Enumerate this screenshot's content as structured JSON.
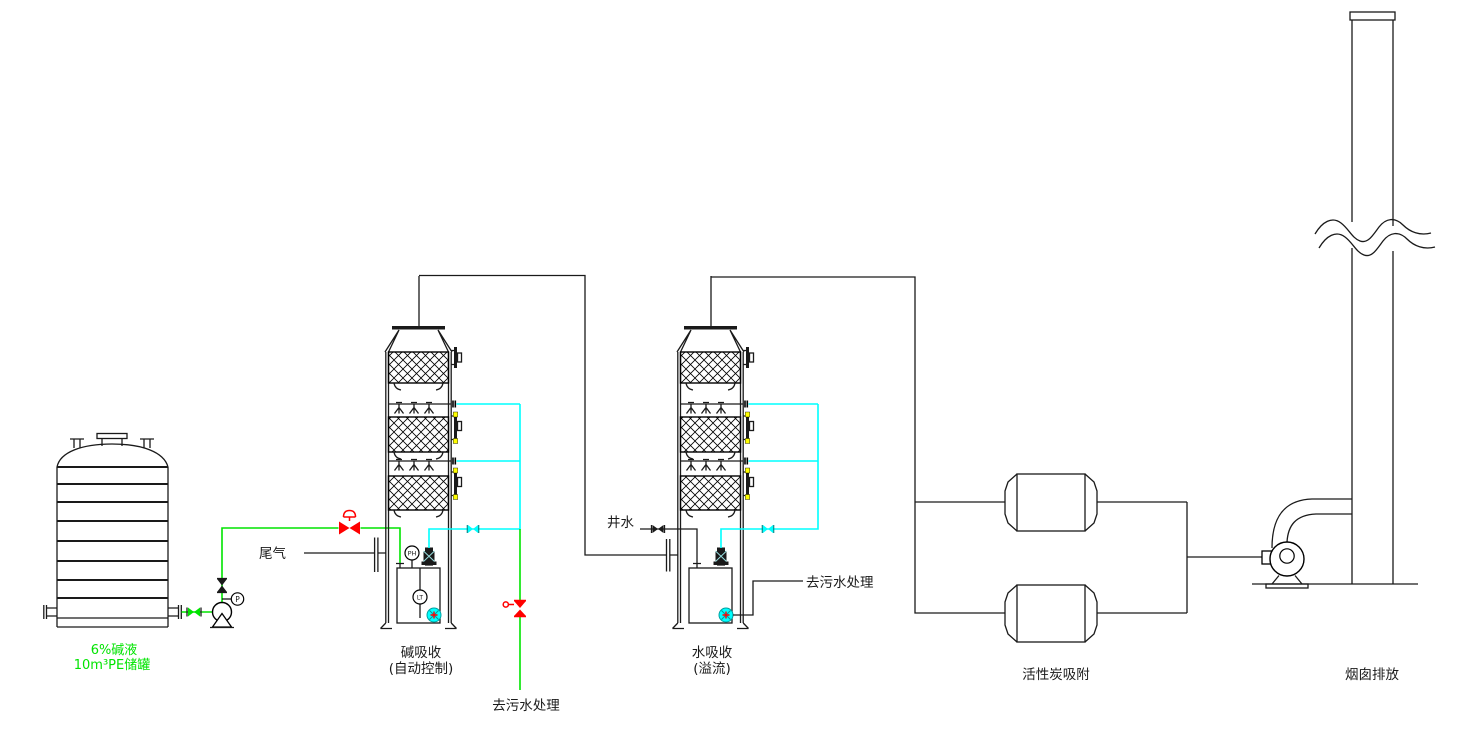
{
  "colors": {
    "background": "#ffffff",
    "line": "#1a1a1a",
    "caustic_green": "#00e400",
    "spray_cyan": "#00ffff",
    "valve_red": "#ff0000",
    "flange_yellow": "#ffff00"
  },
  "labels": {
    "tank_spec_line1": "6%碱液",
    "tank_spec_line2": "10m³PE储罐",
    "tail_gas": "尾气",
    "well_water": "井水",
    "to_wastewater_drain": "去污水处理",
    "to_wastewater_overflow": "去污水处理",
    "tower1_name": "碱吸收",
    "tower1_mode": "(自动控制)",
    "tower2_name": "水吸收",
    "tower2_mode": "(溢流)",
    "carbon_adsorber": "活性炭吸附",
    "stack": "烟囱排放",
    "ph_analyzer": "PH",
    "level_transmitter": "LT",
    "pressure_gauge": "P"
  }
}
